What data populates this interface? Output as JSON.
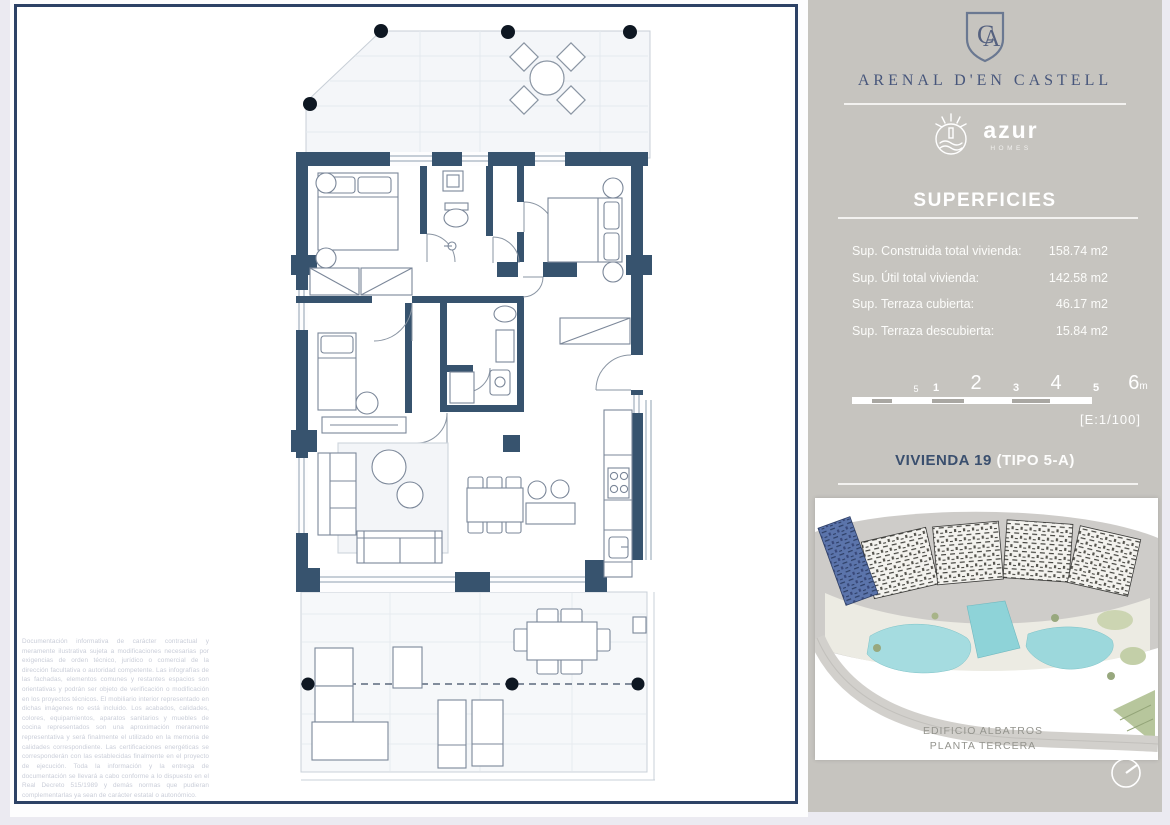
{
  "header": {
    "monogram": "CA",
    "project": "ARENAL D'EN CASTELL",
    "brand": "azur",
    "brand_sub": "HOMES"
  },
  "superficies": {
    "title": "SUPERFICIES",
    "rows": [
      {
        "label": "Sup. Construida total vivienda:",
        "value": "158.74 m2"
      },
      {
        "label": "Sup. Útil total vivienda:",
        "value": "142.58 m2"
      },
      {
        "label": "Sup. Terraza cubierta:",
        "value": "46.17 m2"
      },
      {
        "label": "Sup. Terraza descubierta:",
        "value": "15.84 m2"
      }
    ]
  },
  "scale_bar": {
    "marks": [
      "5",
      "1",
      "2",
      "3",
      "4",
      "5",
      "6"
    ],
    "unit": "m",
    "ratio": "[E:1/100]"
  },
  "unit_title": {
    "name": "VIVIENDA 19",
    "type": "(TIPO 5-A)"
  },
  "site_plan": {
    "caption_line1": "EDIFICIO ALBATROS",
    "caption_line2": "PLANTA TERCERA"
  },
  "disclaimer": "Documentación informativa de carácter contractual y meramente ilustrativa sujeta a modificaciones necesarias por exigencias de orden técnico, jurídico o comercial de la dirección facultativa o autoridad competente. Las infografías de las fachadas, elementos comunes y restantes espacios son orientativas y podrán ser objeto de verificación o modificación en los proyectos técnicos. El mobiliario interior representado en dichas imágenes no está incluido. Los acabados, calidades, colores, equipamientos, aparatos sanitarios y muebles de cocina representados son una aproximación meramente representativa y será finalmente el utilizado en la memoria de calidades correspondiente. Las certificaciones energéticas se corresponderán con las establecidas finalmente en el proyecto de ejecución. Toda la información y la entrega de documentación se llevará a cabo conforme a lo dispuesto en el Real Decreto 515/1989 y demás normas que pudieran complementarlas ya sean de carácter estatal o autonómico.",
  "colors": {
    "accent_navy": "#2d4266",
    "wall": "#37536e",
    "panel_gray": "#c6c4bf",
    "pool": "#8ed3d8",
    "highlight_unit": "#5b74ab"
  }
}
